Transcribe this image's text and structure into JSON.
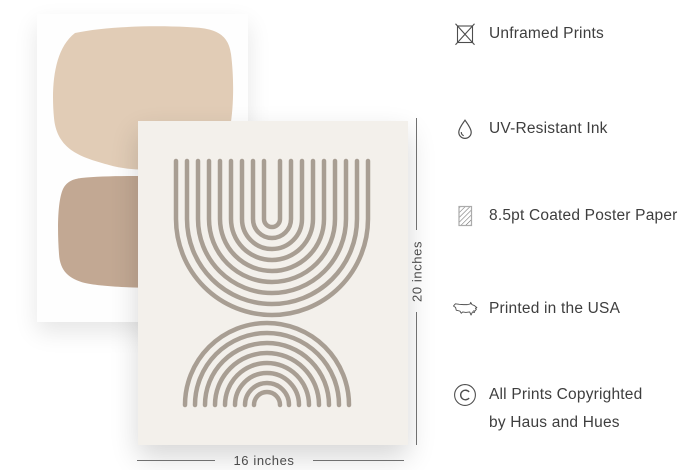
{
  "posters": {
    "back": {
      "background": "#fefefe",
      "shape_top_color": "#e1ccb6",
      "shape_bottom_color": "#c2a893"
    },
    "front": {
      "background": "#f3f0eb",
      "line_color": "#a89e93",
      "art": "two stacks of concentric arches: upper U-shaped arcs, lower rainbow arcs"
    }
  },
  "dimensions": {
    "height_label": "20 inches",
    "width_label": "16 inches"
  },
  "features": {
    "items": [
      {
        "icon": "unframed-icon",
        "label": "Unframed Prints"
      },
      {
        "icon": "drop-icon",
        "label": "UV-Resistant Ink"
      },
      {
        "icon": "paper-icon",
        "label": "8.5pt Coated Poster Paper"
      },
      {
        "icon": "usa-map-icon",
        "label": "Printed in the USA"
      },
      {
        "icon": "copyright-icon",
        "lines": [
          "All Prints Copyrighted",
          "by Haus and Hues"
        ]
      }
    ]
  },
  "colors": {
    "beige-light": "#e1ccb6",
    "beige-dark": "#c2a893",
    "poster-bg": "#f3f0eb",
    "art-line": "#a89e93",
    "text": "#3e3e3e",
    "dim-line": "#707070",
    "icon-stroke": "#4d4d4d",
    "page-bg": "#ffffff"
  }
}
